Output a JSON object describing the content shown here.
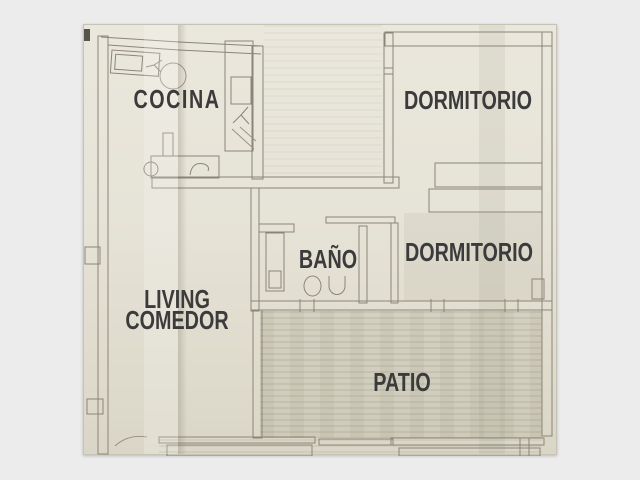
{
  "colors": {
    "background": "#ececec",
    "paper": "#e7e4d9",
    "line": "#8b8578",
    "label": "#3b3b3b"
  },
  "rooms": {
    "cocina": "COCINA",
    "dormitorio_top": "DORMITORIO",
    "bano": "BAÑO",
    "dormitorio_mid": "DORMITORIO",
    "living_line1": "LIVING",
    "living_line2": "COMEDOR",
    "patio": "PATIO"
  }
}
